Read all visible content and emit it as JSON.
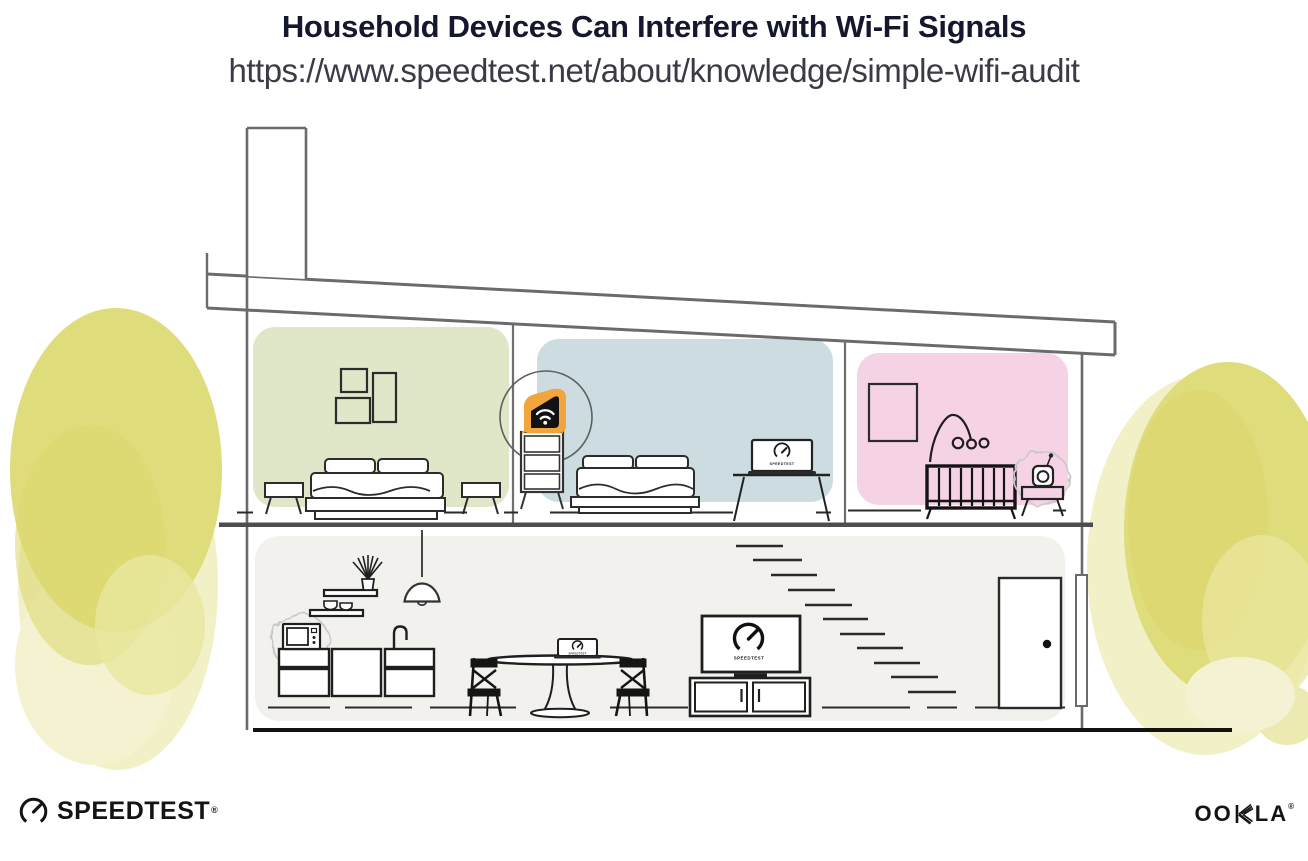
{
  "header": {
    "title": "Household Devices Can Interfere with Wi-Fi Signals",
    "url": "https://www.speedtest.net/about/knowledge/simple-wifi-audit"
  },
  "illustration": {
    "screen_label": "SPEEDTEST",
    "devices": [
      "wifi-router",
      "laptop",
      "tv",
      "microwave",
      "baby-monitor"
    ],
    "colors": {
      "accent_orange": "#f2a43d",
      "bedroom_green": "#dfe7c8",
      "bedroom_blue": "#ccdce0",
      "nursery_pink": "#f5d3e5",
      "living_gray": "#f2f1ee",
      "foliage_yellow": "#dfdc7b",
      "outline_gray": "#6b6b6b",
      "ink": "#1f1f1f"
    }
  },
  "footer": {
    "speedtest_text": "SPEEDTEST",
    "speedtest_trademark": "®",
    "ookla_part1": "OO",
    "ookla_part2": "LA",
    "ookla_trademark": "®"
  }
}
